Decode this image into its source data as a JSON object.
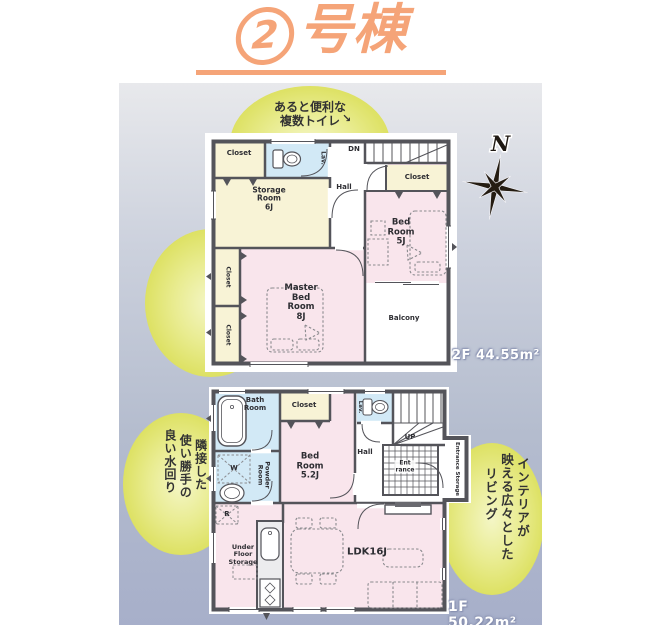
{
  "title": {
    "circled_number": "2",
    "suffix": "号棟"
  },
  "compass": {
    "north_label": "N"
  },
  "callouts": {
    "multi_toilet": {
      "line1": "あると便利な",
      "line2": "複数トイレ",
      "arrow": "↘"
    },
    "bright_room": {
      "col1": "バルコニーに面した",
      "col2": "明るい洋室"
    },
    "water_area": {
      "col1": "キッチンに",
      "col2": "隣接した",
      "col3": "使い勝手の",
      "col4": "良い水回り"
    },
    "living": {
      "col1": "インテリアが",
      "col2": "映える広々とした",
      "col3": "リビング"
    }
  },
  "floor2": {
    "area_label": "2F 44.55m²",
    "rooms": {
      "closet_top": "Closet",
      "toilet": "Lav.",
      "stairs": "DN",
      "hall": "Hall",
      "storage": "Storage\nRoom\n6J",
      "closet_right": "Closet",
      "bedroom": "Bed\nRoom\n5J",
      "master": "Master\nBed\nRoom\n8J",
      "closet_left1": "Closet",
      "closet_left2": "Closet",
      "balcony": "Balcony"
    }
  },
  "floor1": {
    "area_label": "1F 50.22m²",
    "rooms": {
      "bath": "Bath\nRoom",
      "closet": "Closet",
      "bedroom": "Bed\nRoom\n5.2J",
      "toilet": "Lav.",
      "stairs": "UP",
      "hall": "Hall",
      "entrance": "Ent\nrance",
      "entrance_storage": "Entrance Storage",
      "powder": "Powder\nRoom",
      "washer": "W",
      "fridge": "R",
      "under_floor": "Under\nFloor\nStorage",
      "ldk": "LDK16J"
    }
  },
  "colors": {
    "title_accent": "#f5a478",
    "bubble_yellow": "#e6e985",
    "room_pink": "#f9e5ec",
    "room_cream": "#f8f3d6",
    "room_blue": "#d2e9f6",
    "wall": "#54545a",
    "panel_top": "#e8e9ec",
    "panel_bottom": "#a7afca"
  }
}
